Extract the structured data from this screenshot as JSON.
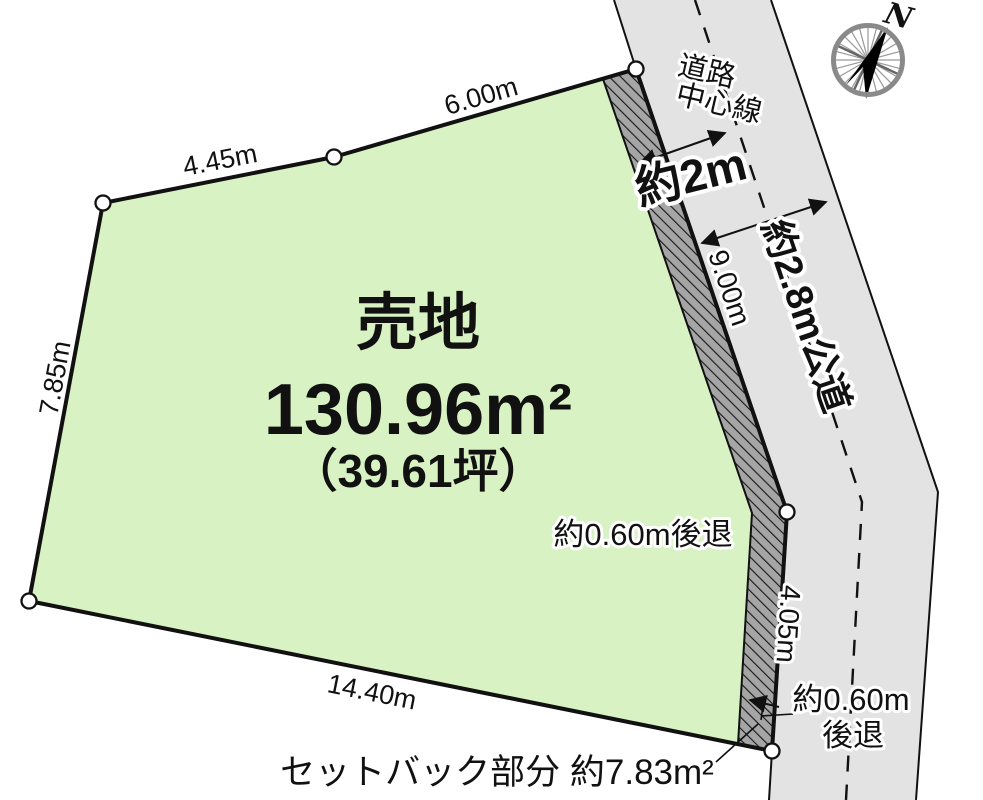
{
  "title": {
    "sale_label": "売地",
    "area": "130.96m²",
    "area_tsubo": "（39.61坪）"
  },
  "dimensions": {
    "edge_top_left": "4.45m",
    "edge_top_right": "6.00m",
    "edge_left": "7.85m",
    "edge_bottom": "14.40m",
    "edge_road_upper": "9.00m",
    "edge_road_lower": "4.05m"
  },
  "road": {
    "centerline_label_line1": "道路",
    "centerline_label_line2": "中心線",
    "dist_to_centerline": "約2m",
    "width_label": "約2.8m公道"
  },
  "setback": {
    "note_inside": "約0.60m後退",
    "note_right_line1": "約0.60m",
    "note_right_line2": "後退",
    "area_note": "セットバック部分 約7.83m²"
  },
  "compass": {
    "north": "N"
  },
  "colors": {
    "land_fill": "#d8f2c3",
    "road_fill": "#e3e3e3",
    "hatch_fill": "#a5a5a5",
    "outline": "#111111"
  }
}
